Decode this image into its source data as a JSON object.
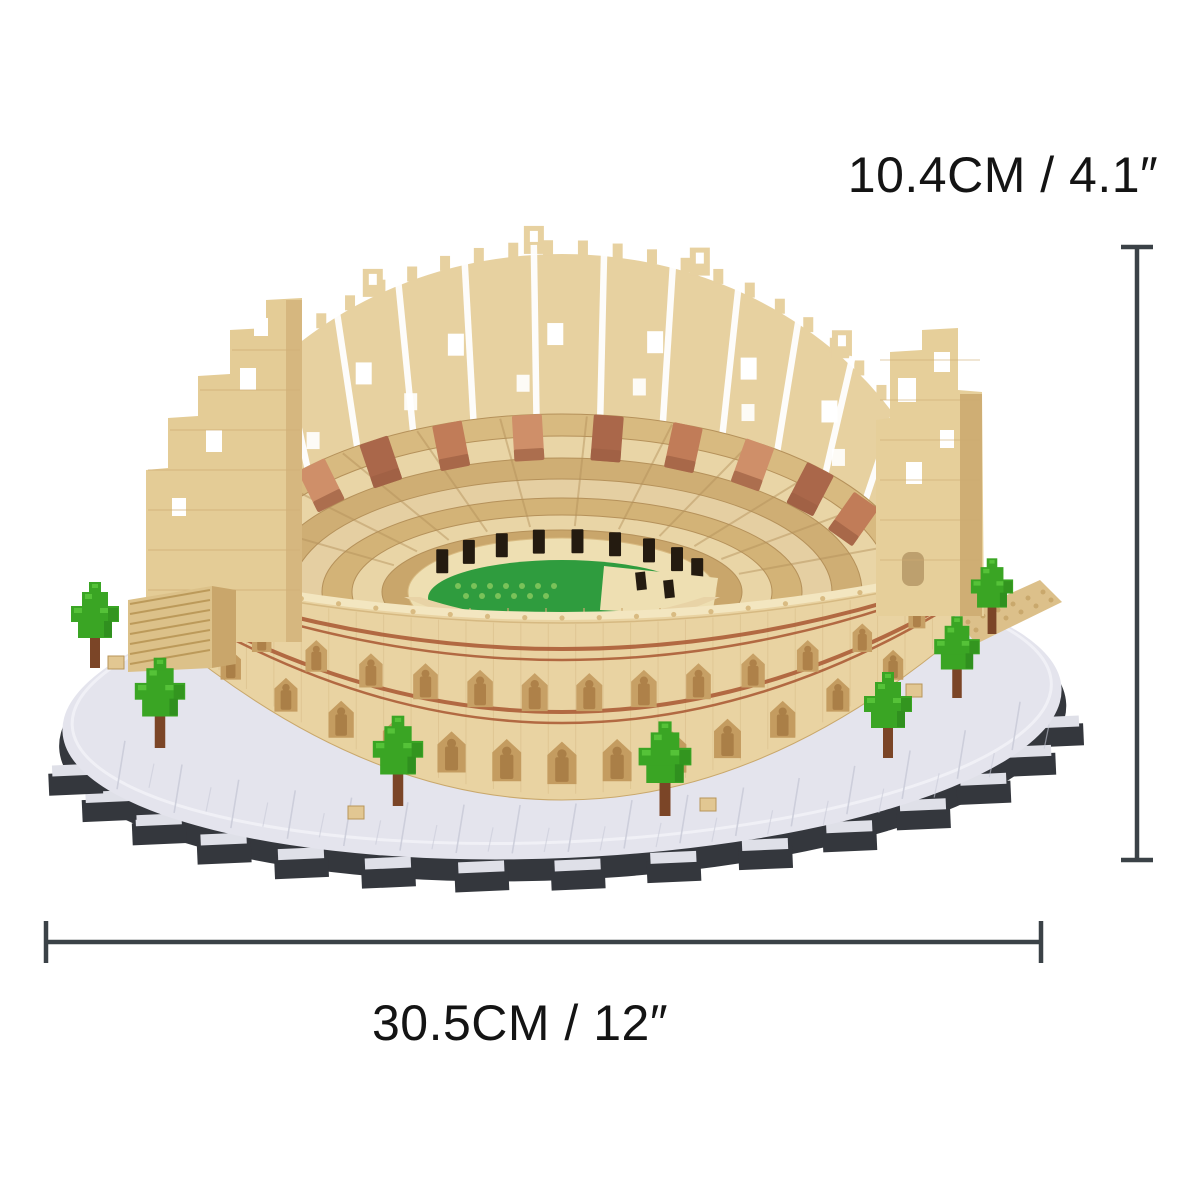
{
  "image": {
    "type": "product dimension photo",
    "subject": "Micro building-block Colosseum model on a grey stepped display base with green trees",
    "background": "#ffffff"
  },
  "annotations": {
    "height_label": "10.4CM / 4.1″",
    "width_label": "30.5CM / 12″"
  },
  "dimension_lines": {
    "height_line": {
      "orientation": "vertical",
      "position": "right of model"
    },
    "width_line": {
      "orientation": "horizontal",
      "position": "below model"
    },
    "color": "#3b4247"
  },
  "colors": {
    "label_ink": "#141414",
    "brick_tan": "#e9d3a2",
    "brick_light": "#f3e6c0",
    "brick_mid": "#d9bb82",
    "brick_shadow": "#c19a60",
    "arch_interior": "#c7a065",
    "statue": "#ae8149",
    "stripe_red": "#ad5f3a",
    "terracotta": "#c17c58",
    "terracotta_dark": "#aa674a",
    "terracotta_light": "#cf8f69",
    "inner_wall_cream": "#eedfb2",
    "doorway_dark": "#241b10",
    "arena_green": "#2f9c3e",
    "arena_stud": "#82c75c",
    "base_grey_top": "#e4e4ed",
    "base_grey_seam": "#c9cbd8",
    "base_dark_edge": "#34373d",
    "tree_green": "#3aa524",
    "tree_green_light": "#55c238",
    "tree_green_dark": "#2e8a1d",
    "tree_trunk": "#7b4527"
  }
}
